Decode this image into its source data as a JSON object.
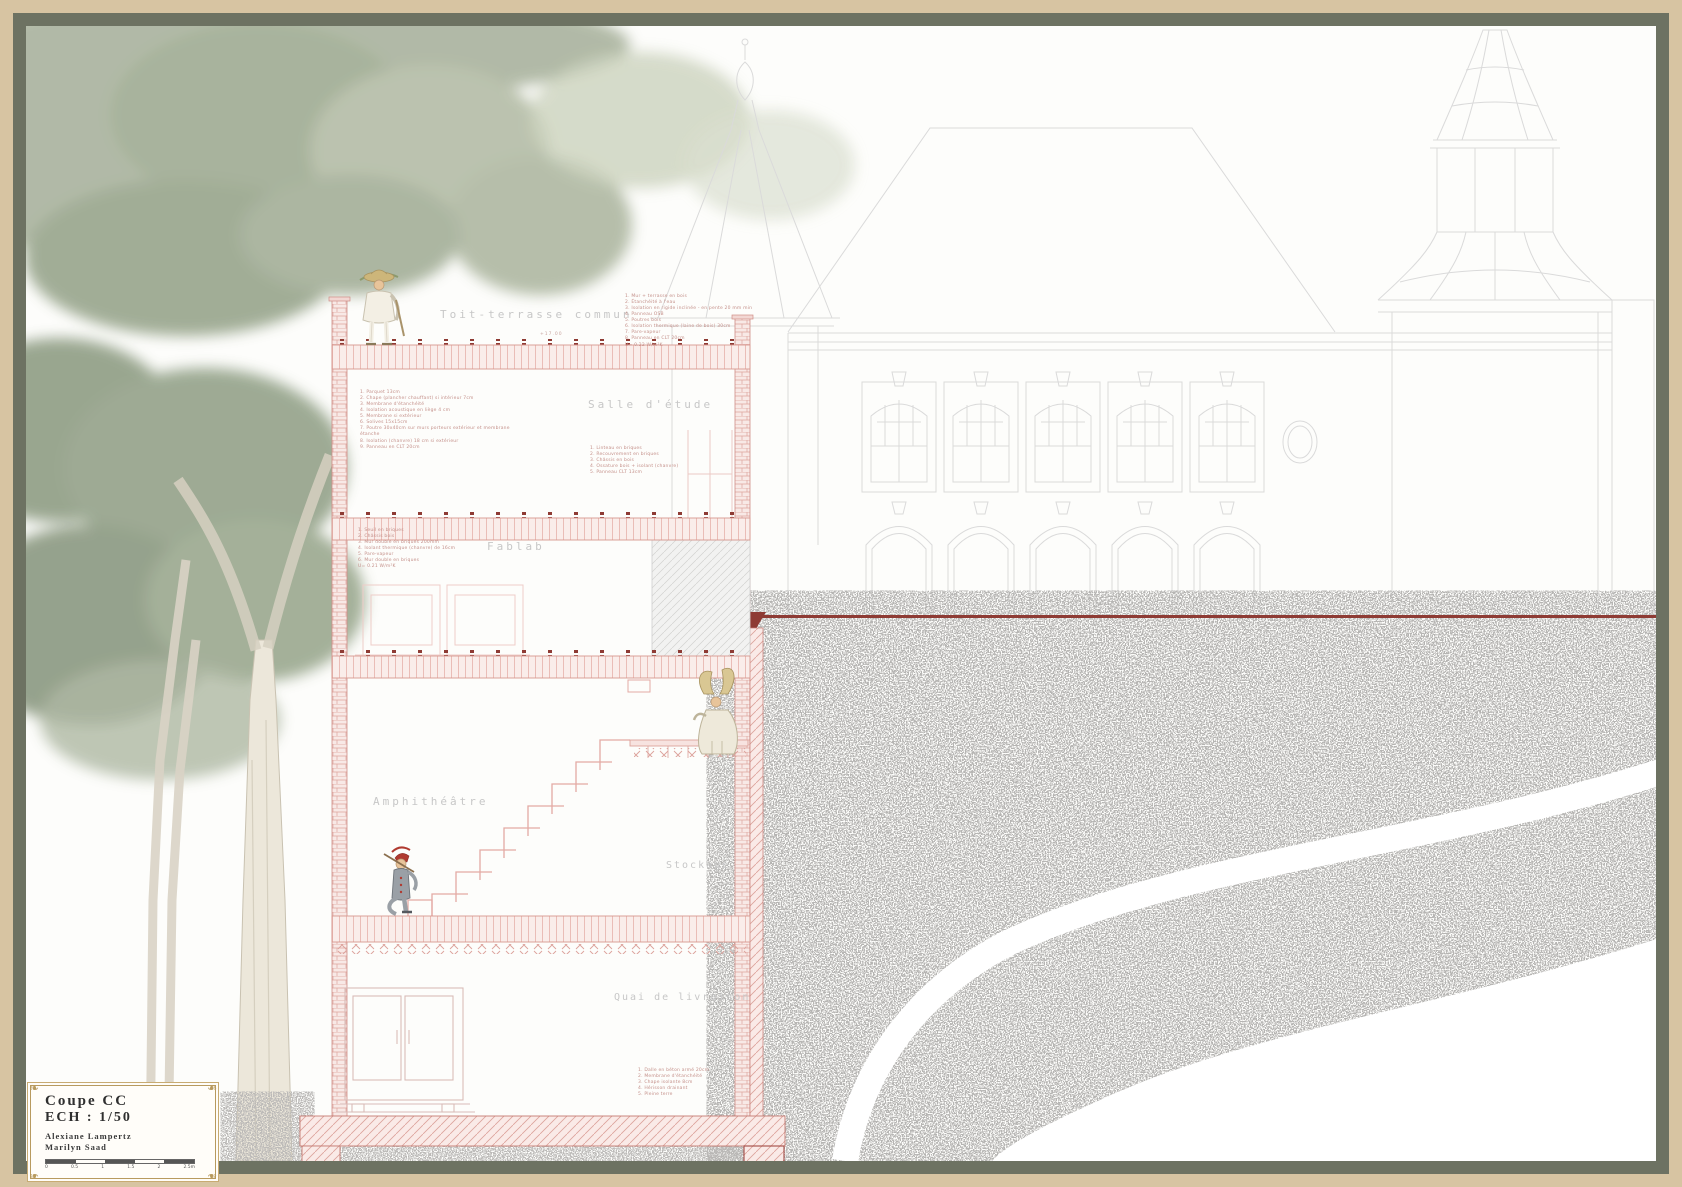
{
  "title_block": {
    "title": "Coupe CC",
    "scale": "ECH : 1/50",
    "authors": [
      "Alexiane Lampertz",
      "Marilyn Saad"
    ],
    "scale_bar_labels": [
      "0",
      "0.5",
      "1",
      "1.5",
      "2",
      "2.5m"
    ]
  },
  "room_labels": {
    "toit": "Toit-terrasse commun",
    "salle": "Salle d'étude",
    "fablab": "Fablab",
    "amphi": "Amphithéâtre",
    "stockage": "Stockage",
    "quai": "Quai de livraison"
  },
  "level_mark": "+17.00",
  "annotations": {
    "roof_list": [
      "1. Mur + terrasse en bois",
      "2. Étanchéité à l'eau",
      "3. Isolation en rigide inclinée - en pente 20 mm min",
      "4. Panneau OSB",
      "5. Poutres bois",
      "6. Isolation thermique (laine de bois) 30cm",
      "7. Pare-vapeur",
      "8. Panneau en CLT 20cm",
      "U= 0.22 W/m²K"
    ],
    "salle_list": [
      "1. Linteau en briques",
      "2. Recouvrement en briques",
      "3. Châssis en bois",
      "4. Ossature bois + isolant (chanvre)",
      "5. Panneau CLT 13cm"
    ],
    "floor2_list": [
      "1. Parquet 13cm",
      "2. Chape (plancher chauffant) si intérieur 7cm",
      "3. Membrane d'étanchéité",
      "4. Isolation acoustique en liège 4 cm",
      "5. Membrane si extérieur",
      "6. Solives 15x15cm",
      "7. Poutre 30x40cm sur murs porteurs extérieur et membrane étanche",
      "8. Isolation (chanvre) 18 cm si extérieur",
      "9. Panneau en CLT 20cm"
    ],
    "fablab_list": [
      "1. Seuil en briques",
      "2. Châssis bois",
      "3. Mur double en briques 200mm",
      "4. Isolant thermique (chanvre) de 16cm",
      "5. Pare-vapeur",
      "6. Mur double en briques",
      "U= 0.21 W/m²K"
    ],
    "quai_list": [
      "1. Dalle en béton armé 20cm",
      "2. Membrane d'étanchéité",
      "3. Chape isolante 8cm",
      "4. Hérisson drainant",
      "5. Pleine terre"
    ]
  },
  "colors": {
    "frame_outer": "#d7c4a2",
    "frame_mat": "#6d7262",
    "section_pink": "#dca29b",
    "accent_dark_red": "#8e3b34",
    "elevation_gray": "#d9d9d9",
    "label_gray": "#c7c7c7"
  },
  "figures": {
    "fig1": "pierrot-with-straw-hat",
    "fig2": "robed-figure-with-headdress",
    "fig3": "harlequin-dancer"
  }
}
